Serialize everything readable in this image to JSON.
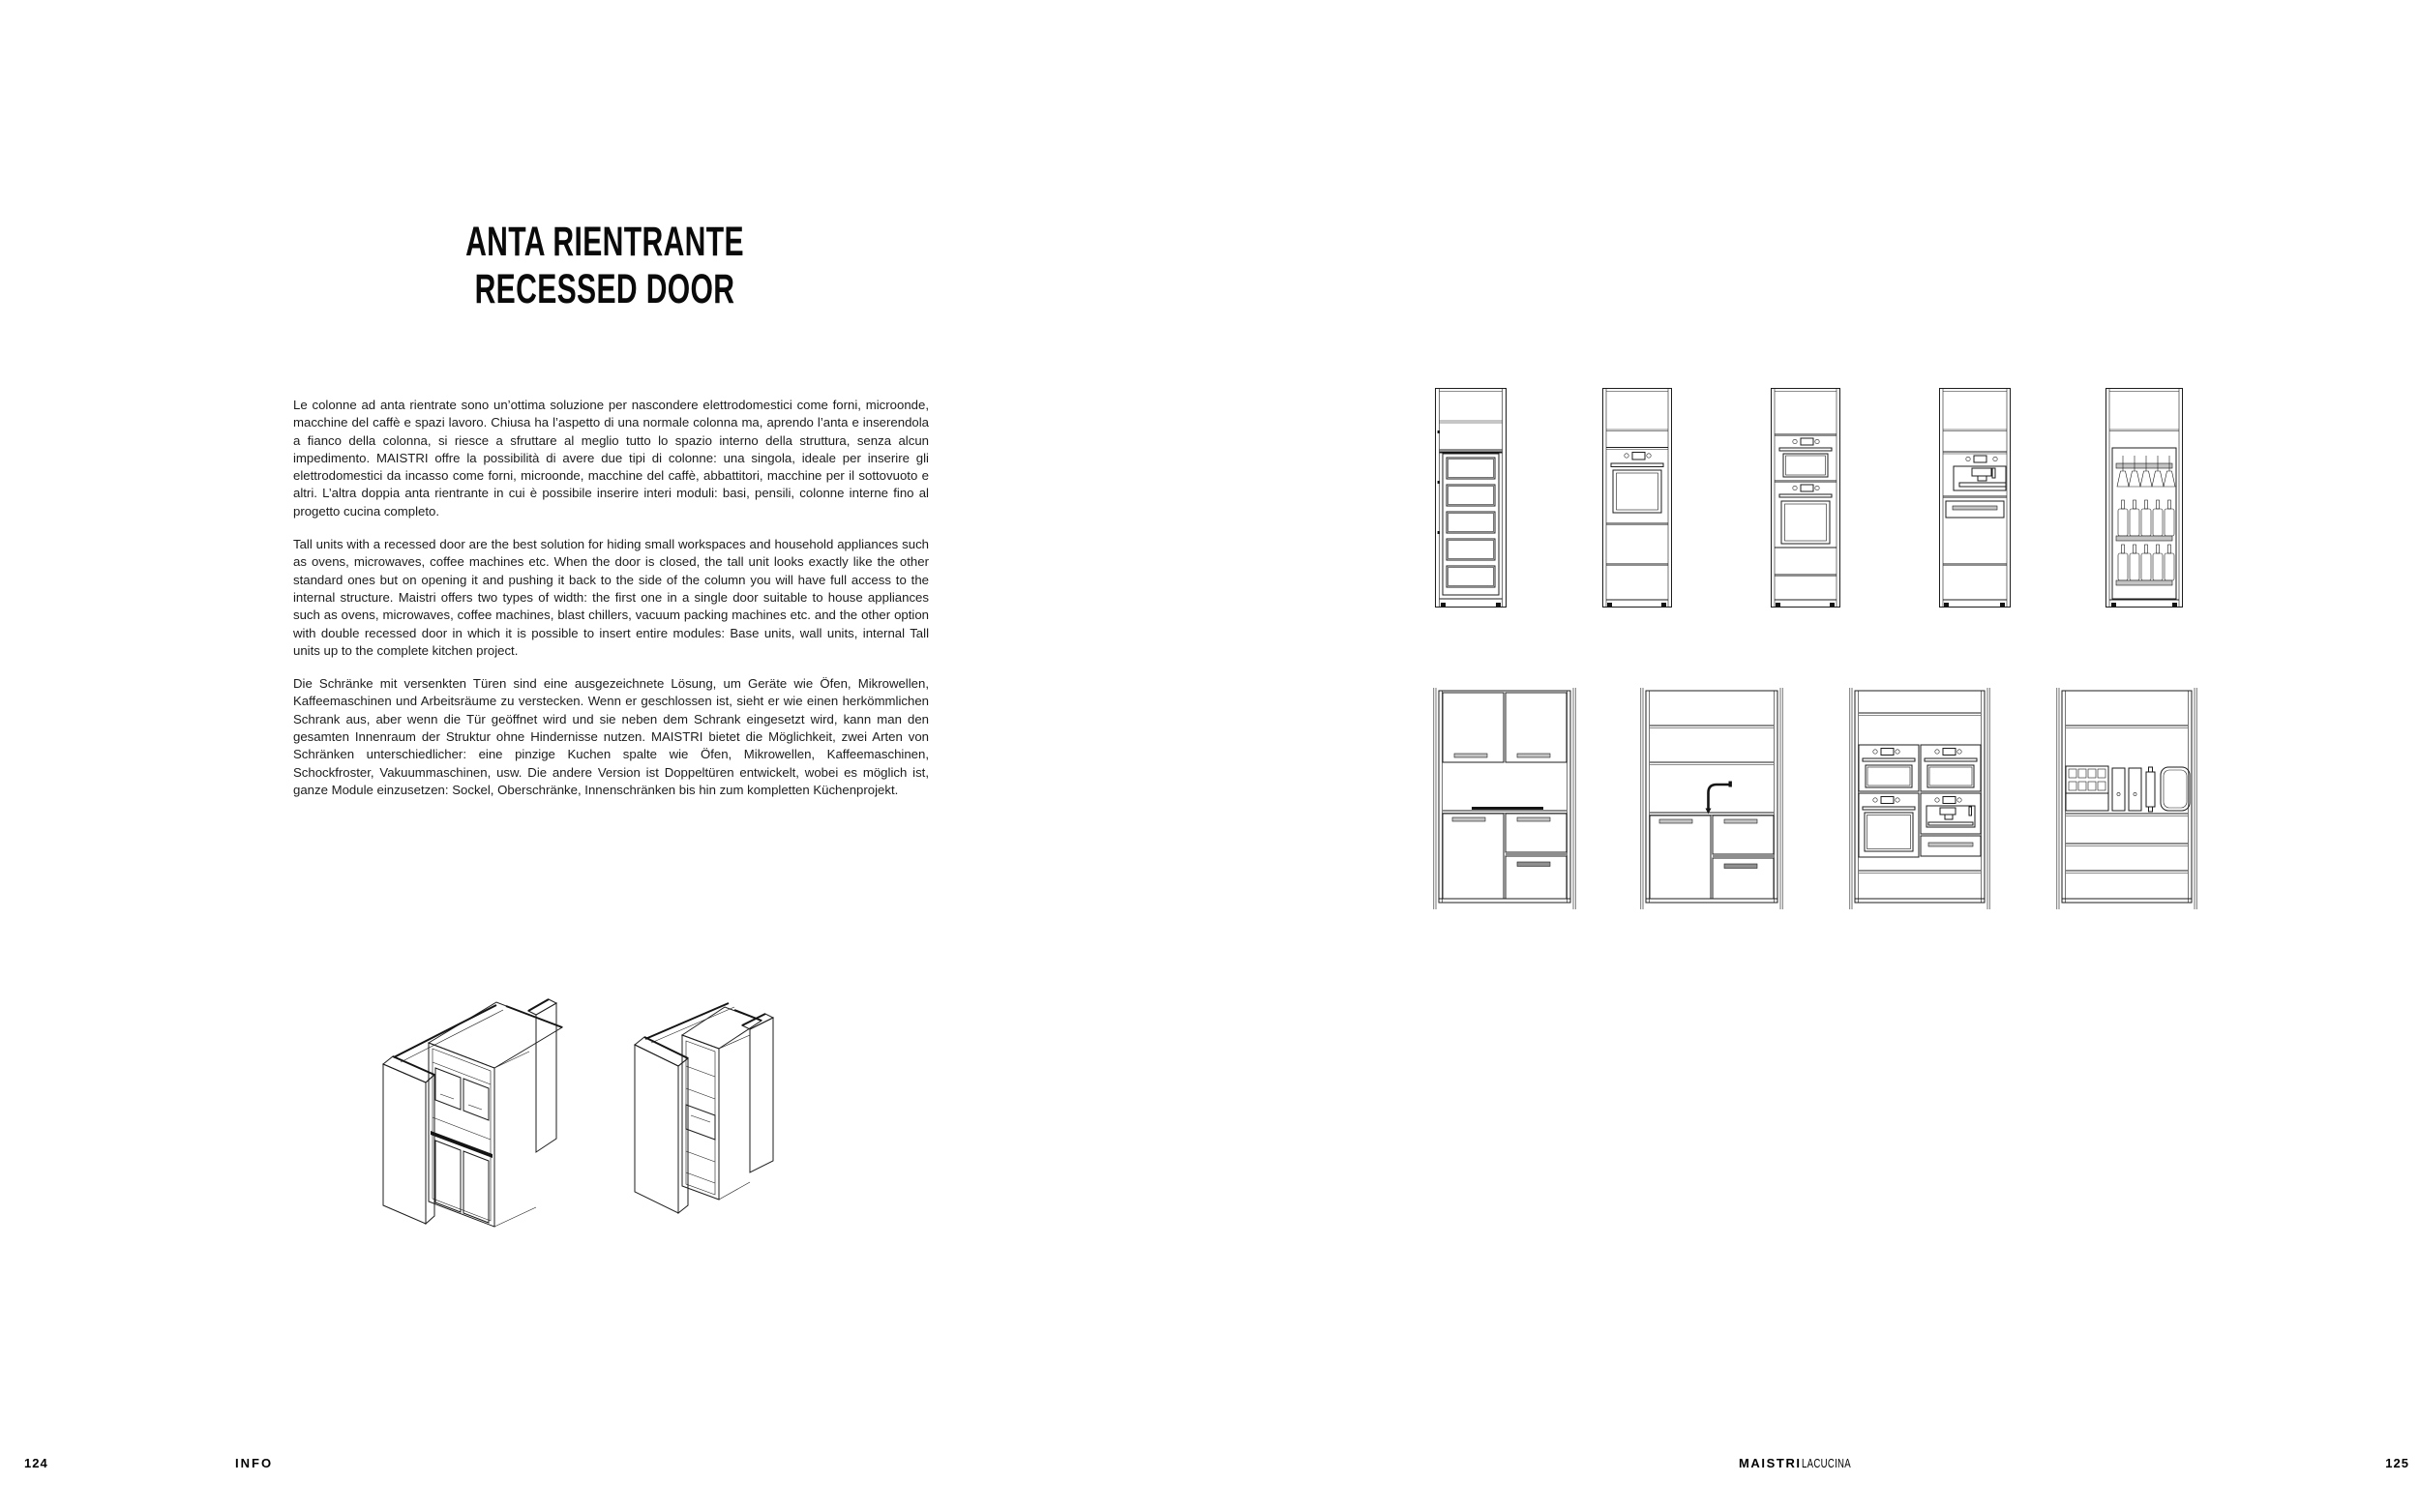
{
  "left_page": {
    "title_line1": "ANTA RIENTRANTE",
    "title_line2": "RECESSED DOOR",
    "paragraph_it": "Le colonne ad anta rientrate sono un’ottima soluzione per nascondere elettrodomestici come forni, microonde, macchine del caffè e spazi lavoro. Chiusa ha l’aspetto di una normale colonna ma, aprendo l’anta e inserendola a fianco della colonna, si riesce a sfruttare al meglio tutto lo spazio interno della struttura, senza alcun impedimento. MAISTRI offre la possibilità di avere due tipi di colonne: una singola, ideale per inserire gli elettrodomestici da incasso come forni, microonde, macchine del caffè, abbattitori, macchine per il sottovuoto e altri. L’altra doppia anta rientrante in cui è possibile inserire interi moduli: basi, pensili, colonne interne fino al progetto cucina completo.",
    "paragraph_en": "Tall units with a recessed door are the best solution for hiding small workspaces and household appliances such as ovens, microwaves, coffee machines etc. When the door is closed, the tall unit looks exactly like the other standard ones but on opening it and pushing it back to the side of the column you will have full access to the internal structure. Maistri offers two types of width: the first one in a single door suitable to house appliances such as ovens, microwaves, coffee machines, blast chillers, vacuum packing machines etc. and the other option with double recessed door in which it is possible to insert entire modules: Base units, wall units, internal Tall units up to the complete kitchen project.",
    "paragraph_de": "Die Schränke mit versenkten Türen sind eine ausgezeichnete Lösung, um Geräte wie Öfen, Mikrowellen, Kaffeemaschinen und Arbeitsräume zu verstecken. Wenn er geschlossen ist, sieht er wie einen herkömmlichen Schrank aus, aber wenn die Tür geöffnet wird und sie neben dem Schrank eingesetzt wird, kann man den gesamten Innenraum der Struktur ohne Hindernisse nutzen. MAISTRI bietet die Möglichkeit, zwei Arten von Schränken unterschiedlicher: eine pinzige Kuchen spalte wie Öfen, Mikrowellen, Kaffeemaschinen, Schockfroster, Vakuummaschinen, usw. Die andere Version ist Doppeltüren entwickelt, wobei es möglich ist, ganze Module einzusetzen: Sockel, Oberschränke, Innenschränken bis hin zum kompletten Küchenprojekt.",
    "page_number": "124",
    "footer_label": "INFO"
  },
  "right_page": {
    "brand_bold": "MAISTRI",
    "brand_light": "LACUCINA",
    "page_number": "125"
  },
  "colors": {
    "ink": "#1c1c1c",
    "paper": "#ffffff"
  }
}
